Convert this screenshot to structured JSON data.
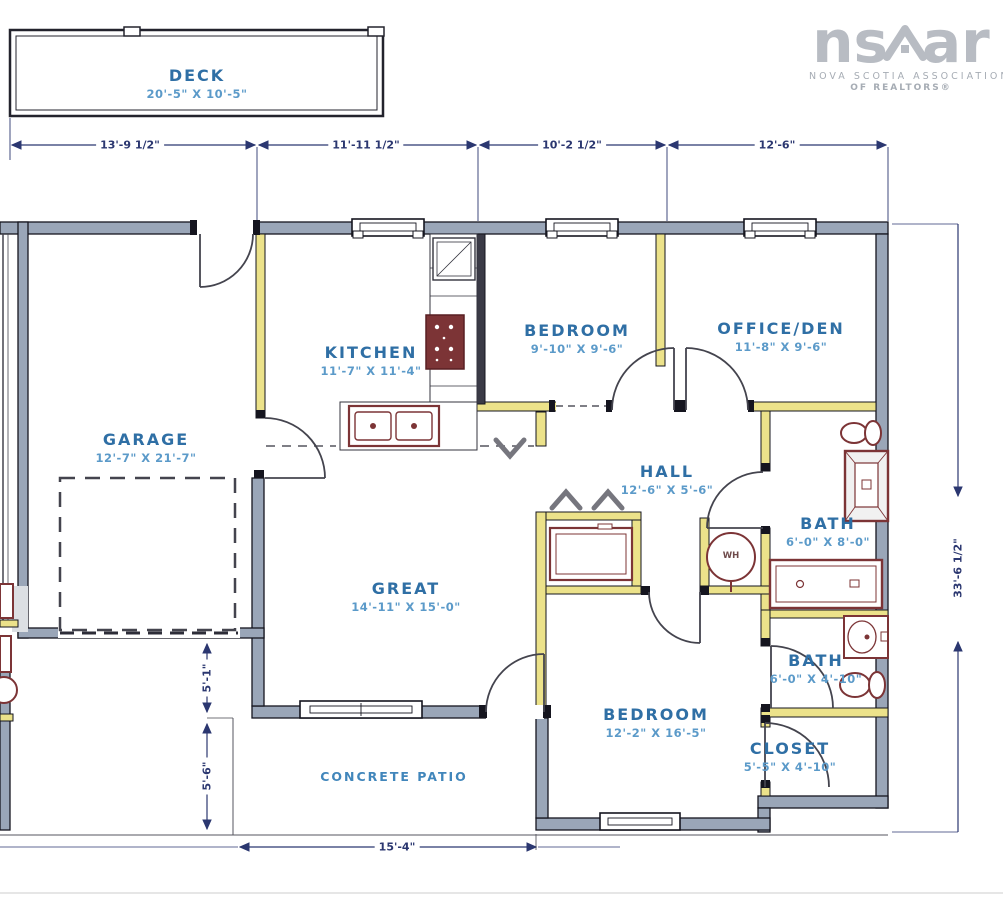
{
  "logo": {
    "word_left": "ns",
    "word_right": "ar",
    "line1": "NOVA SCOTIA ASSOCIATION",
    "line2": "OF REALTORS®"
  },
  "rooms": {
    "deck": {
      "name": "DECK",
      "dims": "20'-5\" X 10'-5\""
    },
    "garage": {
      "name": "GARAGE",
      "dims": "12'-7\" X 21'-7\""
    },
    "kitchen": {
      "name": "KITCHEN",
      "dims": "11'-7\" X 11'-4\""
    },
    "bedroom1": {
      "name": "BEDROOM",
      "dims": "9'-10\" X 9'-6\""
    },
    "office": {
      "name": "OFFICE/DEN",
      "dims": "11'-8\" X 9'-6\""
    },
    "hall": {
      "name": "HALL",
      "dims": "12'-6\" X 5'-6\""
    },
    "bath1": {
      "name": "BATH",
      "dims": "6'-0\" X 8'-0\""
    },
    "great": {
      "name": "GREAT",
      "dims": "14'-11\" X 15'-0\""
    },
    "bedroom2": {
      "name": "BEDROOM",
      "dims": "12'-2\" X 16'-5\""
    },
    "bath2": {
      "name": "BATH",
      "dims": "6'-0\" X 4'-10\""
    },
    "closet": {
      "name": "CLOSET",
      "dims": "5'-5\" X 4'-10\""
    },
    "patio": {
      "name": "CONCRETE PATIO"
    },
    "water_heater": {
      "label": "WH"
    }
  },
  "dimensions": {
    "top": [
      "13'-9 1/2\"",
      "11'-11 1/2\"",
      "10'-2 1/2\"",
      "12'-6\""
    ],
    "right": "33'-6 1/2\"",
    "left_upper": "5'-1\"",
    "left_lower": "5'-6\"",
    "bottom": "15'-4\""
  },
  "colors": {
    "wall_exterior": "#9aa6b8",
    "wall_interior": "#ece28a",
    "room_name_blue": "#2f6fa5",
    "room_dim_blue": "#5b9ac9",
    "dimension_navy": "#2b3770",
    "fixture_red": "#7c3436",
    "logo_gray": "#b8bcc3"
  }
}
